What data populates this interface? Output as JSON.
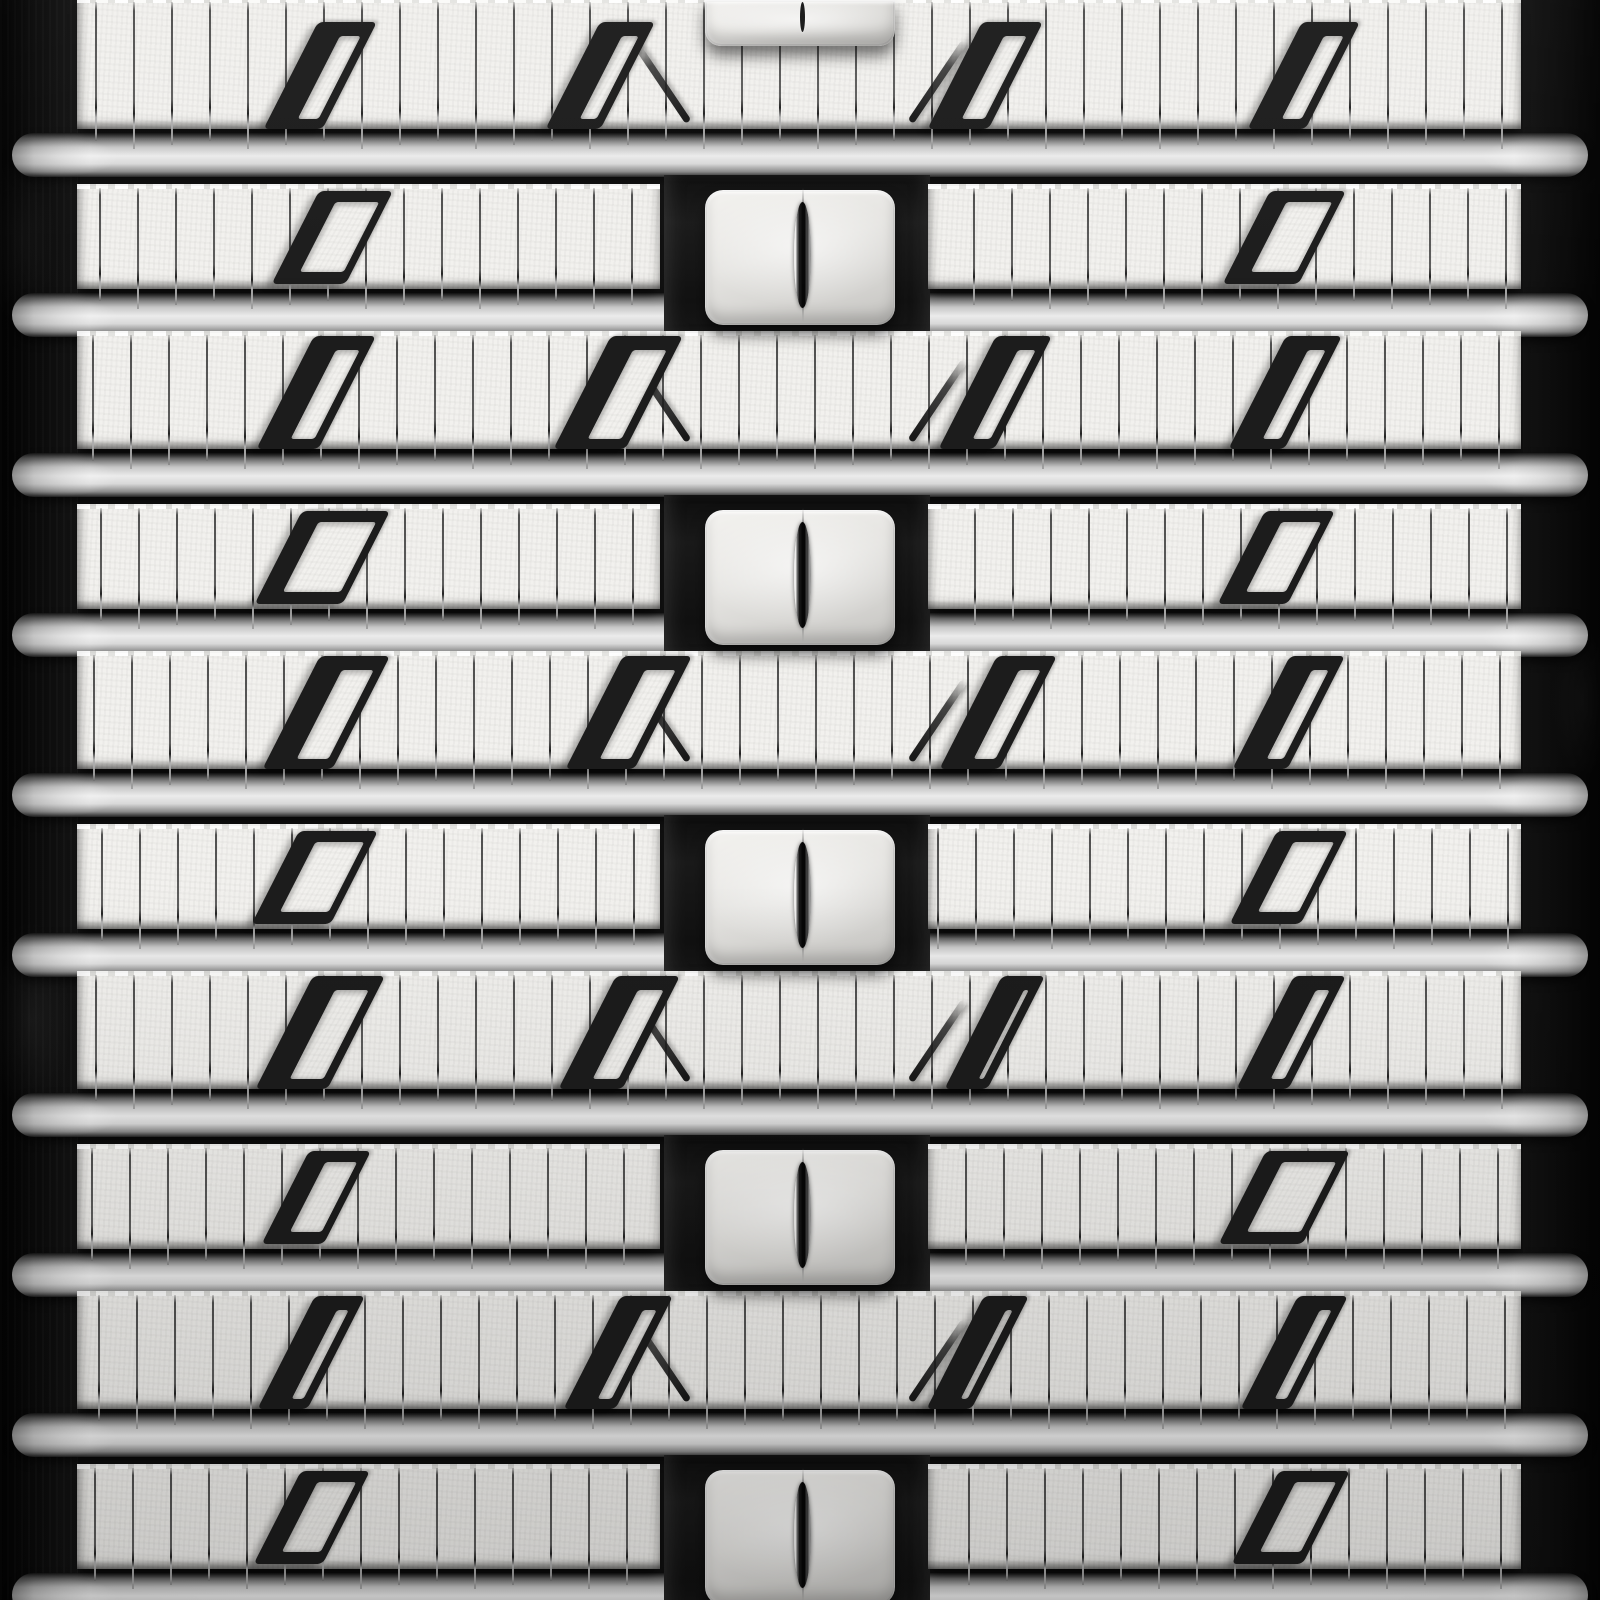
{
  "subject": "grayscale close-up photograph of a rubber track tread pattern",
  "palette": {
    "background": "#101010",
    "margin_dark": "#060606",
    "tread_face": "#f2f1ee",
    "bar_highlight": "#ebebeb",
    "cutout_dark": "#1c1c1c",
    "lug_low": "#c3c2bf",
    "slot_dark": "#060606",
    "sipe_dark": "#3a3a3a",
    "sipe_tip_light": "#a8a8a8"
  },
  "geometry": {
    "width": 1600,
    "height": 1600,
    "row_pitch": 160,
    "row_count": 10,
    "face": {
      "left": 77,
      "right": 1521,
      "center_gap_left": 660,
      "center_gap_right": 928,
      "top_offset_through": 13,
      "top_offset_lug": 26,
      "bottom_offset": 129
    },
    "bar": {
      "x": 12,
      "width": 1576,
      "top_rise": 27,
      "height": 44
    },
    "panel": {
      "x": 664,
      "width": 266,
      "top_offset": 15,
      "bottom_offset": 173
    },
    "lug": {
      "x": 705,
      "width": 190,
      "top_offset": 30,
      "height": 135,
      "radius": 18
    },
    "slot": {
      "x": 794,
      "width": 17,
      "top_offset": 42,
      "height": 106
    },
    "seam": {
      "x": 802,
      "top_offset": 28,
      "height": 134
    },
    "sipes": {
      "start": 95,
      "step": 38,
      "width": 2,
      "overhang": 10
    },
    "diagonals": {
      "left_x": 658,
      "right_x": 934,
      "top_offset": 20,
      "height": 96,
      "angle_deg": 34
    },
    "cut": {
      "skew_deg": -27,
      "top_inset_through": 3,
      "top_inset_lug": 5,
      "bottom_inset_lug": 5,
      "row0_top": 22
    },
    "top_remnant": {
      "x": 705,
      "y": 0,
      "width": 190,
      "height": 46,
      "panel_height": 54
    }
  },
  "rows": [
    {
      "index": 0,
      "type": "through",
      "sipe_phase": 0,
      "cutouts": [
        [
          263,
          377
        ],
        [
          545,
          655
        ],
        [
          927,
          1043
        ],
        [
          1247,
          1360
        ]
      ]
    },
    {
      "index": 1,
      "type": "lug",
      "sipe_phase": 4,
      "cutouts": [
        [
          272,
          393
        ],
        [
          1223,
          1346
        ]
      ]
    },
    {
      "index": 2,
      "type": "through",
      "sipe_phase": -3,
      "cutouts": [
        [
          256,
          376
        ],
        [
          553,
          683
        ],
        [
          938,
          1052
        ],
        [
          1228,
          1342
        ]
      ]
    },
    {
      "index": 3,
      "type": "lug",
      "sipe_phase": 5,
      "cutouts": [
        [
          255,
          390
        ],
        [
          1218,
          1335
        ]
      ]
    },
    {
      "index": 4,
      "type": "through",
      "sipe_phase": -2,
      "cutouts": [
        [
          262,
          390
        ],
        [
          565,
          692
        ],
        [
          939,
          1057
        ],
        [
          1232,
          1345
        ]
      ]
    },
    {
      "index": 5,
      "type": "lug",
      "sipe_phase": 6,
      "cutouts": [
        [
          252,
          378
        ],
        [
          1230,
          1348
        ]
      ]
    },
    {
      "index": 6,
      "type": "through",
      "sipe_phase": 0,
      "cutouts": [
        [
          255,
          385
        ],
        [
          558,
          680
        ],
        [
          944,
          1045
        ],
        [
          1236,
          1346
        ]
      ]
    },
    {
      "index": 7,
      "type": "lug",
      "sipe_phase": -4,
      "cutouts": [
        [
          262,
          371
        ],
        [
          1219,
          1350
        ]
      ]
    },
    {
      "index": 8,
      "type": "through",
      "sipe_phase": 3,
      "cutouts": [
        [
          257,
          365
        ],
        [
          563,
          673
        ],
        [
          926,
          1029
        ],
        [
          1240,
          1348
        ]
      ]
    },
    {
      "index": 9,
      "type": "lug",
      "sipe_phase": -1,
      "cutouts": [
        [
          254,
          370
        ],
        [
          1232,
          1350
        ]
      ]
    }
  ]
}
